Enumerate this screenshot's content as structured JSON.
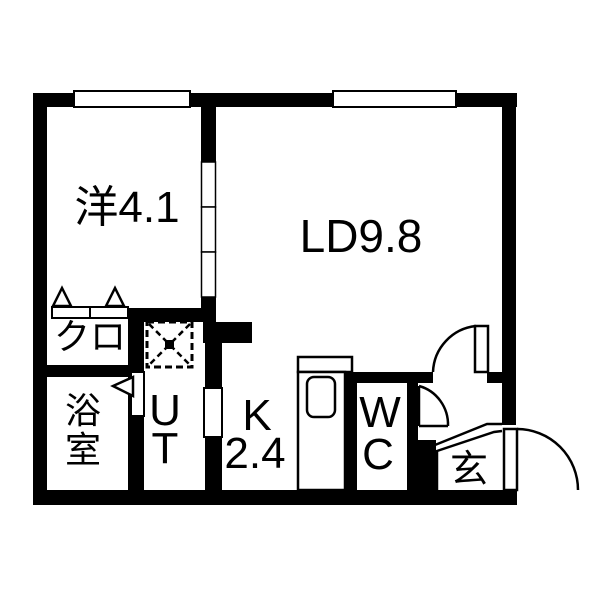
{
  "colors": {
    "wall": "#000000",
    "floor": "#ffffff",
    "line": "#000000"
  },
  "rooms": {
    "western": {
      "label": "洋4.1"
    },
    "living_dining": {
      "label": "LD9.8"
    },
    "closet": {
      "label": "クロ"
    },
    "bathroom": {
      "char1": "浴",
      "char2": "室"
    },
    "utility": {
      "char1": "U",
      "char2": "T"
    },
    "kitchen": {
      "line1": "K",
      "line2": "2.4"
    },
    "wc": {
      "char1": "W",
      "char2": "C"
    },
    "entrance": {
      "label": "玄"
    }
  },
  "symbols": {
    "windows": [
      "window-west-room",
      "window-living-dining"
    ],
    "doors": [
      "sliding-door-west-ld",
      "closet-folding-door",
      "bathroom-door",
      "utility-door",
      "ld-hall-door",
      "wc-door",
      "entrance-door"
    ],
    "fixtures": [
      "washing-machine-pan",
      "kitchen-sink-counter",
      "entrance-step-line"
    ]
  }
}
